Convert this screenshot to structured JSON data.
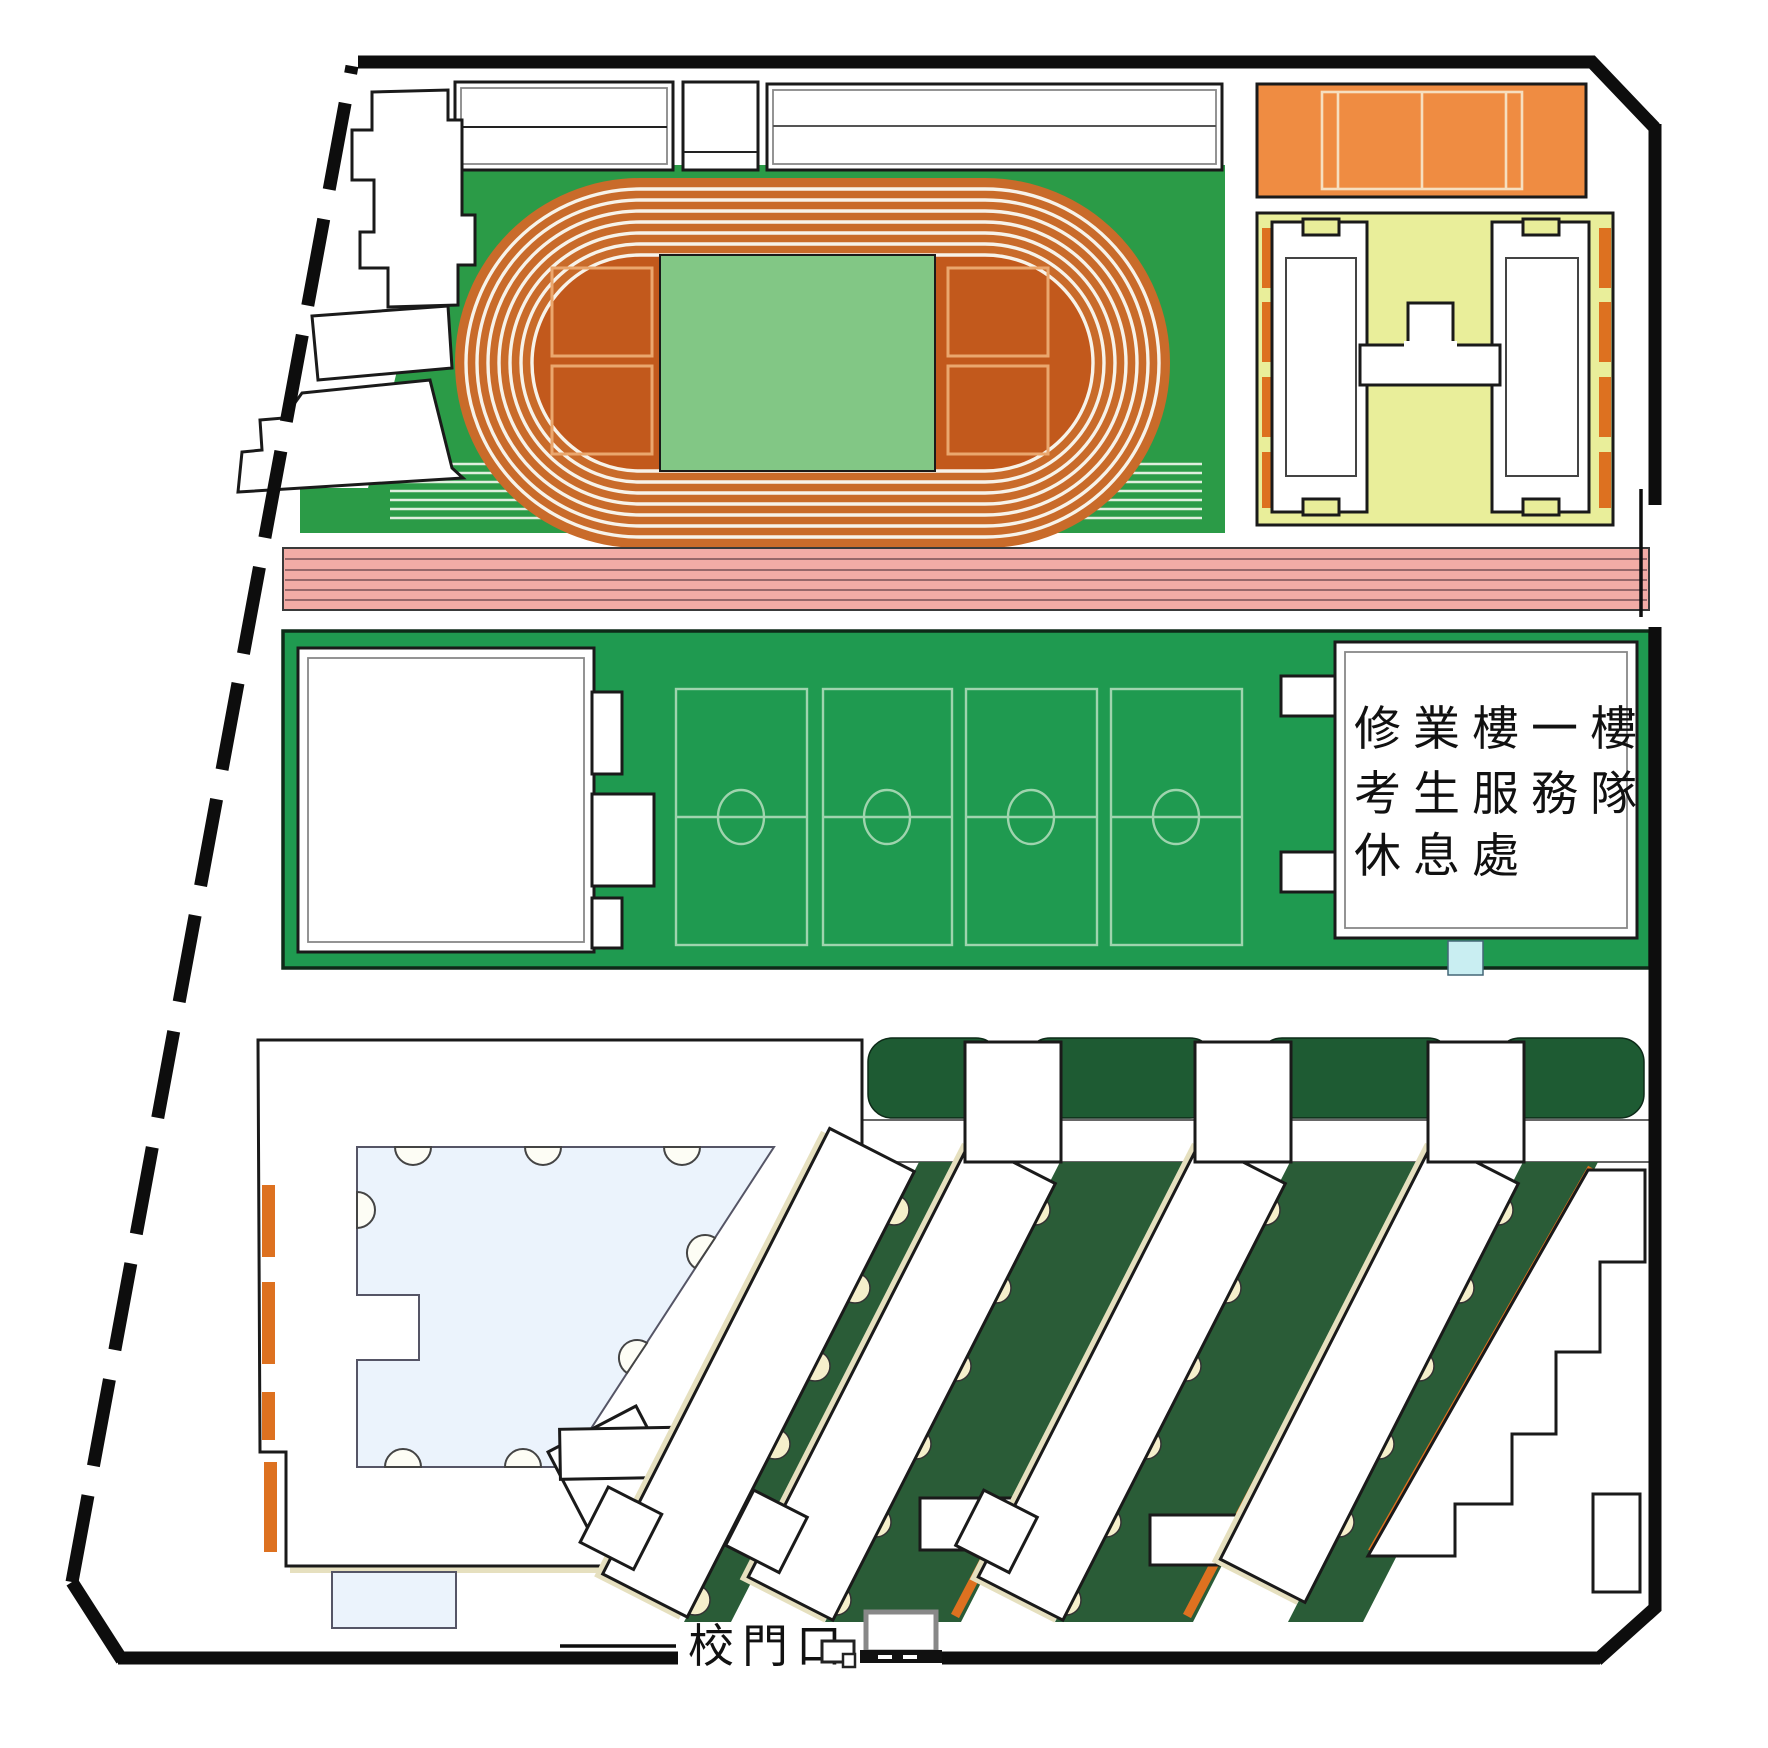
{
  "map": {
    "type": "campus-map",
    "labels": {
      "rest_area": [
        "修業樓一樓",
        "考生服務隊",
        "休息處"
      ],
      "gate": "校門口"
    },
    "icons": [
      "gate-booth-icon",
      "gate-monitor-icon"
    ],
    "colors": {
      "boundary": "#0d0d0d",
      "track-lane": "#c96b2a",
      "infield": "#c2591c",
      "field-green": "#2b9b47",
      "center-green": "#82c785",
      "mid-green": "#1f9a50",
      "pink": "#f2aca6",
      "yellow-block": "#e9ee9a",
      "court-orange": "#ef8c42",
      "orange-accent": "#dd7120",
      "hedge": "#1e5b33",
      "garden": "#2a5c37",
      "scallop": "#f5efcb",
      "courtyard-blue": "#ebf3fc",
      "cyan": "#c9eef2"
    }
  }
}
